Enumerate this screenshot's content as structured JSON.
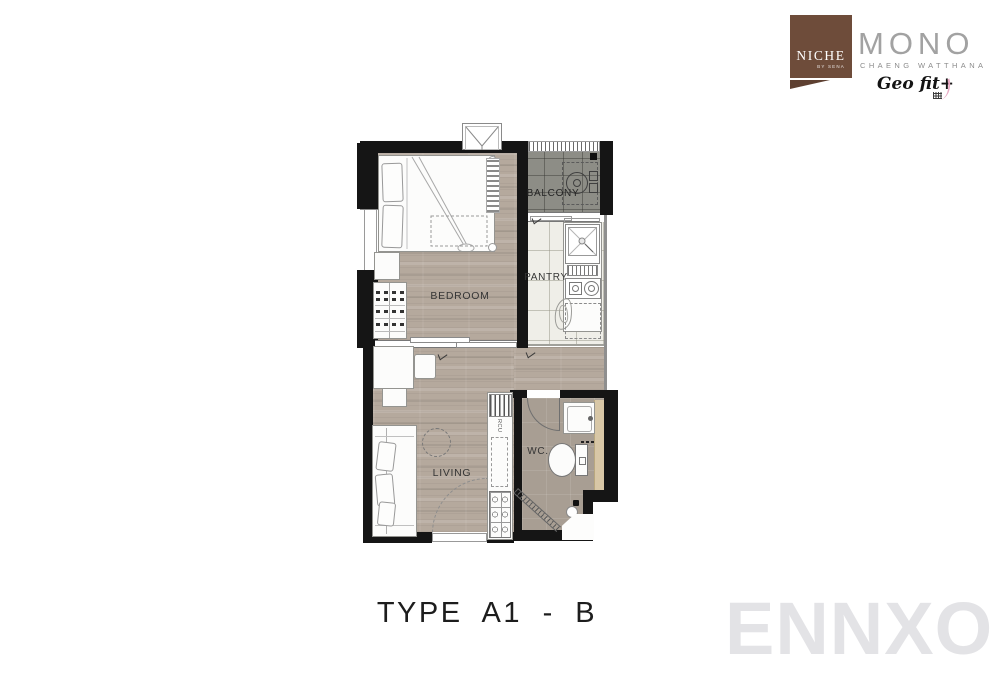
{
  "header": {
    "badge": {
      "title": "NICHE",
      "subtitle": "BY SENA"
    },
    "brand": {
      "name": "MONO",
      "location": "CHAENG WATTHANA",
      "tagline": "Geo fit+"
    }
  },
  "plan": {
    "type_label": "TYPE A1 - B",
    "rooms": {
      "bedroom": "BEDROOM",
      "balcony": "BALCONY",
      "pantry": "PANTRY",
      "living": "LIVING",
      "wc": "WC."
    },
    "counter_label": "RCU"
  },
  "watermark": {
    "text": "ENNXO"
  },
  "colors": {
    "wall": "#151515",
    "wood_floor": "#b5a99d",
    "balcony_floor": "#8d8d86",
    "pantry_floor": "#efeee8",
    "wc_floor": "#a89e93",
    "badge_brown": "#6e4c3a",
    "accent_pink": "#e9a8c3",
    "watermark_gray": "#e3e3e6"
  }
}
